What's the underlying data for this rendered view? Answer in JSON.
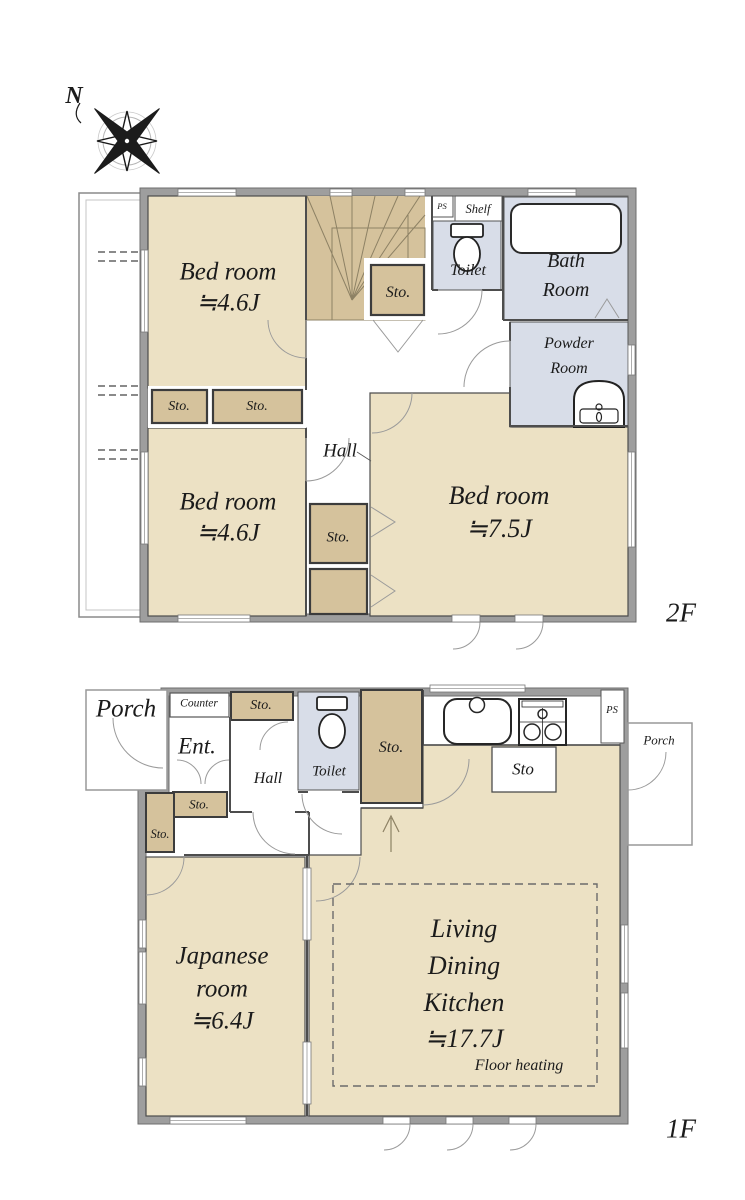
{
  "compass": {
    "north": "N"
  },
  "floor2": {
    "label": "2F",
    "bedroom_a": {
      "name": "Bed room",
      "area": "≒4.6J"
    },
    "bedroom_b": {
      "name": "Bed room",
      "area": "≒4.6J"
    },
    "bedroom_c": {
      "name": "Bed room",
      "area": "≒7.5J"
    },
    "bath": {
      "line1": "Bath",
      "line2": "Room"
    },
    "powder": {
      "line1": "Powder",
      "line2": "Room"
    },
    "toilet": "Toilet",
    "shelf": "Shelf",
    "ps": "PS",
    "hall": "Hall",
    "sto": "Sto."
  },
  "floor1": {
    "label": "1F",
    "porch_left": "Porch",
    "porch_right": "Porch",
    "counter": "Counter",
    "entrance": "Ent.",
    "hall": "Hall",
    "toilet": "Toilet",
    "ps": "PS",
    "sto": "Sto.",
    "sto_open": "Sto",
    "japanese_room": {
      "line1": "Japanese",
      "line2": "room",
      "area": "≒6.4J"
    },
    "ldk": {
      "line1": "Living",
      "line2": "Dining",
      "line3": "Kitchen",
      "area": "≒17.7J",
      "note": "Floor heating"
    }
  },
  "colors": {
    "room_beige": "#ECE1C4",
    "closet_tan": "#D5C29C",
    "wet_area_blue": "#D8DDE8",
    "wall_gray": "#9E9E9E",
    "line_dark": "#4D4D4D"
  }
}
